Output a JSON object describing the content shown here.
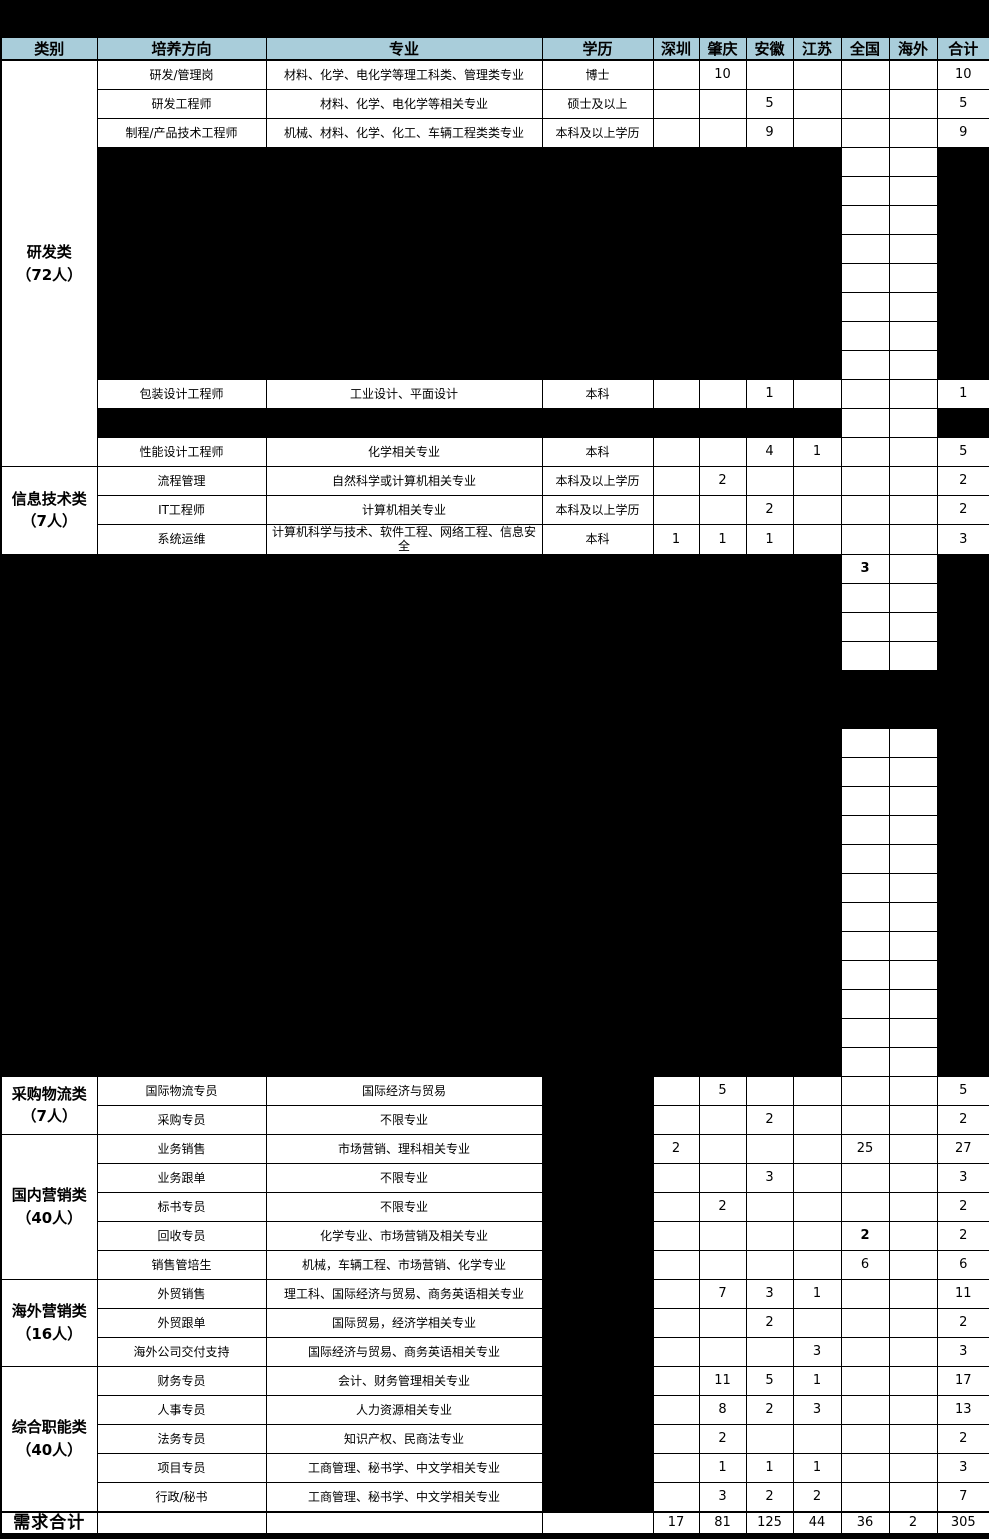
{
  "colors": {
    "header_bg": "#a9cdda",
    "redaction": "#000000",
    "grid": "#000000",
    "text": "#000000"
  },
  "table": {
    "columns": [
      {
        "key": "category",
        "label": "类别"
      },
      {
        "key": "direction",
        "label": "培养方向"
      },
      {
        "key": "major",
        "label": "专业"
      },
      {
        "key": "degree",
        "label": "学历"
      },
      {
        "key": "shenzhen",
        "label": "深圳"
      },
      {
        "key": "zhaoqing",
        "label": "肇庆"
      },
      {
        "key": "anhui",
        "label": "安徽"
      },
      {
        "key": "jiangsu",
        "label": "江苏"
      },
      {
        "key": "national",
        "label": "全国"
      },
      {
        "key": "overseas",
        "label": "海外"
      },
      {
        "key": "total",
        "label": "合计"
      }
    ],
    "sections": [
      {
        "id": "rd",
        "category": "研发类\n（72人）",
        "category_redacted": false,
        "rows": [
          {
            "direction": "研发/管理岗",
            "major": "材料、化学、电化学等理工科类、管理类专业",
            "degree": "博士",
            "values": {
              "zhaoqing": "10",
              "total": "10"
            }
          },
          {
            "direction": "研发工程师",
            "major": "材料、化学、电化学等相关专业",
            "degree": "硕士及以上",
            "values": {
              "anhui": "5",
              "total": "5"
            }
          },
          {
            "direction": "制程/产品技术工程师",
            "major": "机械、材料、化学、化工、车辆工程类类专业",
            "degree": "本科及以上学历",
            "values": {
              "anhui": "9",
              "total": "9"
            }
          },
          {
            "redacted": "partial",
            "count": 8
          },
          {
            "direction": "包装设计工程师",
            "major": "工业设计、平面设计",
            "degree": "本科",
            "values": {
              "anhui": "1",
              "total": "1"
            }
          },
          {
            "redacted": "partial",
            "count": 1
          },
          {
            "direction": "性能设计工程师",
            "major": "化学相关专业",
            "degree": "本科",
            "values": {
              "anhui": "4",
              "jiangsu": "1",
              "total": "5"
            }
          }
        ]
      },
      {
        "id": "it",
        "category": "信息技术类\n（7人）",
        "category_redacted": false,
        "rows": [
          {
            "direction": "流程管理",
            "major": "自然科学或计算机相关专业",
            "degree": "本科及以上学历",
            "values": {
              "zhaoqing": "2",
              "total": "2"
            }
          },
          {
            "direction": "IT工程师",
            "major": "计算机相关专业",
            "degree": "本科及以上学历",
            "values": {
              "anhui": "2",
              "total": "2"
            }
          },
          {
            "direction": "系统运维",
            "major": "计算机科学与技术、软件工程、网络工程、信息安全",
            "degree": "本科",
            "values": {
              "shenzhen": "1",
              "zhaoqing": "1",
              "anhui": "1",
              "total": "3"
            }
          }
        ]
      },
      {
        "id": "redacted-zone",
        "category": "",
        "category_redacted": true,
        "rows": [
          {
            "redacted": "partial",
            "count": 1,
            "values": {
              "national": "3"
            },
            "bold": [
              "national"
            ]
          },
          {
            "redacted": "partial",
            "count": 3
          },
          {
            "redacted": "full",
            "count": 2
          },
          {
            "redacted": "partial",
            "count": 12
          }
        ]
      },
      {
        "id": "procurement-logistics",
        "category": "采购物流类\n（7人）",
        "category_redacted": false,
        "rows": [
          {
            "direction": "国际物流专员",
            "major": "国际经济与贸易",
            "degree_redacted": true,
            "values": {
              "zhaoqing": "5",
              "total": "5"
            }
          },
          {
            "direction": "采购专员",
            "major": "不限专业",
            "degree_redacted": true,
            "values": {
              "anhui": "2",
              "total": "2"
            }
          }
        ]
      },
      {
        "id": "domestic-marketing",
        "category": "国内营销类\n（40人）",
        "category_redacted": false,
        "rows": [
          {
            "direction": "业务销售",
            "major": "市场营销、理科相关专业",
            "degree_redacted": true,
            "values": {
              "shenzhen": "2",
              "national": "25",
              "total": "27"
            }
          },
          {
            "direction": "业务跟单",
            "major": "不限专业",
            "degree_redacted": true,
            "values": {
              "anhui": "3",
              "total": "3"
            }
          },
          {
            "direction": "标书专员",
            "major": "不限专业",
            "degree_redacted": true,
            "values": {
              "zhaoqing": "2",
              "total": "2"
            }
          },
          {
            "direction": "回收专员",
            "major": "化学专业、市场营销及相关专业",
            "degree_redacted": true,
            "values": {
              "national": "2",
              "total": "2"
            },
            "bold": [
              "national"
            ]
          },
          {
            "direction": "销售管培生",
            "major": "机械，车辆工程、市场营销、化学专业",
            "degree_redacted": true,
            "values": {
              "national": "6",
              "total": "6"
            }
          }
        ]
      },
      {
        "id": "overseas-marketing",
        "category": "海外营销类\n（16人）",
        "category_redacted": false,
        "rows": [
          {
            "direction": "外贸销售",
            "major": "理工科、国际经济与贸易、商务英语相关专业",
            "degree_redacted": true,
            "values": {
              "zhaoqing": "7",
              "anhui": "3",
              "jiangsu": "1",
              "total": "11"
            }
          },
          {
            "direction": "外贸跟单",
            "major": "国际贸易，经济学相关专业",
            "degree_redacted": true,
            "values": {
              "anhui": "2",
              "total": "2"
            }
          },
          {
            "direction": "海外公司交付支持",
            "major": "国际经济与贸易、商务英语相关专业",
            "degree_redacted": true,
            "values": {
              "jiangsu": "3",
              "total": "3"
            }
          }
        ]
      },
      {
        "id": "general-functions",
        "category": "综合职能类\n（40人）",
        "category_redacted": false,
        "rows": [
          {
            "direction": "财务专员",
            "major": "会计、财务管理相关专业",
            "degree_redacted": true,
            "values": {
              "zhaoqing": "11",
              "anhui": "5",
              "jiangsu": "1",
              "total": "17"
            }
          },
          {
            "direction": "人事专员",
            "major": "人力资源相关专业",
            "degree_redacted": true,
            "values": {
              "zhaoqing": "8",
              "anhui": "2",
              "jiangsu": "3",
              "total": "13"
            }
          },
          {
            "direction": "法务专员",
            "major": "知识产权、民商法专业",
            "degree_redacted": true,
            "values": {
              "zhaoqing": "2",
              "total": "2"
            }
          },
          {
            "direction": "项目专员",
            "major": "工商管理、秘书学、中文学相关专业",
            "degree_redacted": true,
            "values": {
              "zhaoqing": "1",
              "anhui": "1",
              "jiangsu": "1",
              "total": "3"
            }
          },
          {
            "direction": "行政/秘书",
            "major": "工商管理、秘书学、中文学相关专业",
            "degree_redacted": true,
            "values": {
              "zhaoqing": "3",
              "anhui": "2",
              "jiangsu": "2",
              "total": "7"
            }
          }
        ]
      }
    ],
    "totals": {
      "label": "需求合计",
      "values": {
        "shenzhen": "17",
        "zhaoqing": "81",
        "anhui": "125",
        "jiangsu": "44",
        "national": "36",
        "overseas": "2",
        "total": "305"
      }
    }
  }
}
